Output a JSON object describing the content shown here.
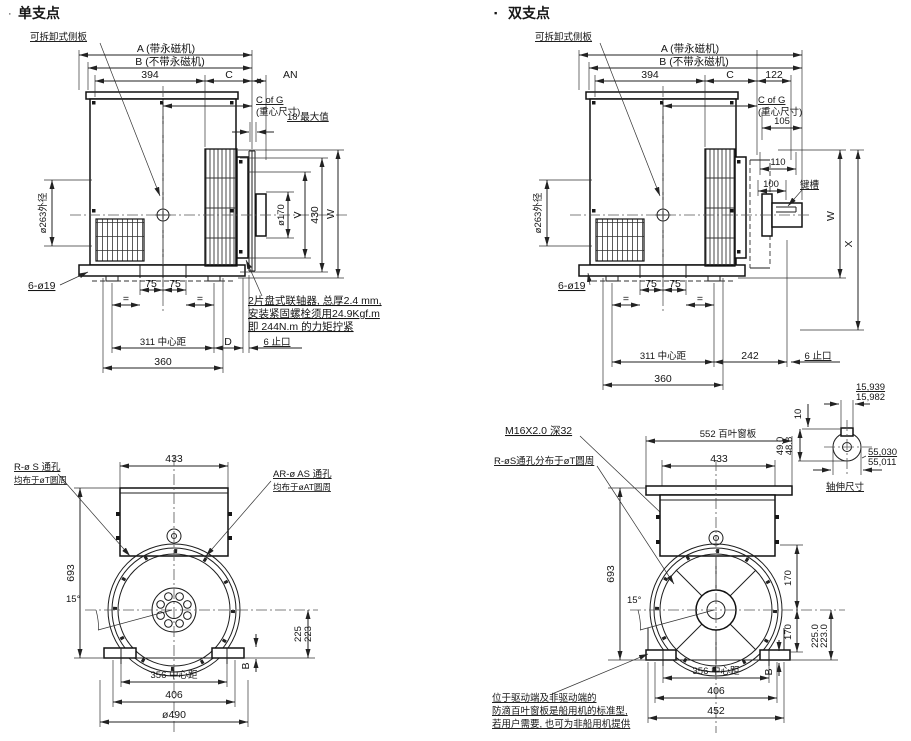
{
  "titles": {
    "single_bullet": "·",
    "single": "单支点",
    "double_bullet": "▪",
    "double": "双支点"
  },
  "single": {
    "side": {
      "removable_panel": "可拆卸式侧板",
      "dim_a": "A (带永磁机)",
      "dim_b": "B (不带永磁机)",
      "dim_394": "394",
      "dim_c": "C",
      "dim_an": "AN",
      "cog1": "C of G",
      "cog2": "(重心尺寸)",
      "dim_18max": "18 最大值",
      "dim_d263": "ø263外径",
      "dim_d170": "ø170",
      "dim_v": "V",
      "dim_430": "430",
      "dim_w": "W",
      "dim_6d19": "6-ø19",
      "dim_75a": "75",
      "dim_75b": "75",
      "eq_a": "=",
      "eq_b": "=",
      "dim_311": "311 中心距",
      "dim_d": "D",
      "dim_6stop": "6 止口",
      "dim_360": "360",
      "note1": "2片盘式联轴器, 总厚2.4 mm,",
      "note2": "安装紧固螺栓须用24.9Kgf.m",
      "note3": "即 244N.m 的力矩拧紧"
    },
    "front": {
      "dim_433": "433",
      "rs1": "R-ø S 通孔",
      "rs2": "均布于øT圆周",
      "aras1": "AR-ø AS 通孔",
      "aras2": "均布于øAT圆周",
      "dim_693": "693",
      "dim_15": "15°",
      "dim_225": "225",
      "dim_223": "223",
      "dim_356": "356 中心距",
      "dim_406": "406",
      "dim_d490": "ø490",
      "dim_b": "B"
    }
  },
  "double": {
    "side": {
      "removable_panel": "可拆卸式侧板",
      "dim_a": "A (带永磁机)",
      "dim_b": "B (不带永磁机)",
      "dim_394": "394",
      "dim_c": "C",
      "dim_122": "122",
      "cog1": "C of G",
      "cog2": "(重心尺寸)",
      "dim_105": "105",
      "dim_110": "110",
      "dim_100": "100",
      "keyway": "键槽",
      "dim_w": "W",
      "dim_x": "X",
      "dim_d263": "ø263外径",
      "dim_6d19": "6-ø19",
      "dim_75a": "75",
      "dim_75b": "75",
      "eq_a": "=",
      "eq_b": "=",
      "dim_311": "311 中心距",
      "dim_242": "242",
      "dim_6stop": "6 止口",
      "dim_360": "360"
    },
    "shaft": {
      "tol_top1": "15,939",
      "tol_top2": "15,982",
      "dim_10": "10",
      "tol_49a": "49.0",
      "tol_49b": "48.8",
      "tol_55a": "55,030",
      "tol_55b": "55,011",
      "caption": "轴伸尺寸"
    },
    "front": {
      "m16": "M16X2.0 深32",
      "rs": "R-øS通孔分布于øT圆周",
      "dim_552": "552 百叶窗板",
      "dim_433": "433",
      "dim_693": "693",
      "dim_15": "15°",
      "dim_170a": "170",
      "dim_170b": "170",
      "dim_225": "225.0",
      "dim_223": "223.0",
      "dim_b": "B",
      "dim_356": "356 中心距",
      "dim_406": "406",
      "dim_452": "452",
      "note1": "位于驱动端及非驱动端的",
      "note2": "防滴百叶窗板是船用机的标准型,",
      "note3": "若用户需要, 也可为非船用机提供"
    }
  }
}
